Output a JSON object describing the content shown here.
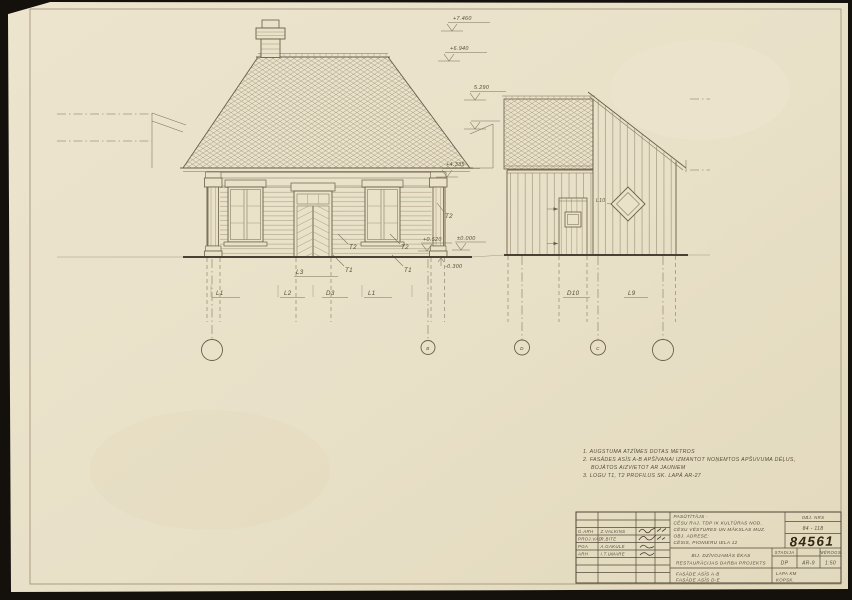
{
  "drawing": {
    "notes": {
      "line1": "1. AUGSTUMA ATZĪMES DOTAS METROS",
      "line2": "2. FASĀDES ASĪS A-B APŠĪVANAI IZMANTOT NOŅEMTOS APŠUVUMA DĒĻUS,",
      "line3": "BOJĀTOS AIZVIETOT AR JAUNIEM",
      "line4": "3. LOGU T1, T2 PROFILUS SK. LAPĀ AR-27"
    },
    "marks": {
      "top1": "+7.460",
      "top2": "+6.940",
      "roof_right": "5.290",
      "eaves": "+4.335",
      "plinth": "+0.520",
      "zero": "±0.000",
      "below": "-0.300"
    },
    "labels": {
      "t2_pilaster": "T2",
      "t2_left": "T2",
      "t2_right": "T2",
      "t1_left": "T1",
      "t1_right": "T1",
      "door_transom": "L3",
      "win1": "L1",
      "win2": "L2",
      "door": "D3",
      "win3": "L1",
      "diamond": "L10",
      "right_door": "D10",
      "right_win": "L9"
    },
    "axes": {
      "a2": "B",
      "a3": "D",
      "a4": "C"
    }
  },
  "title_block": {
    "sig_rows": [
      {
        "role": "G.ARH",
        "name": "Z.VALKINS"
      },
      {
        "role": "PROJ.VAD",
        "name": "R.BITE"
      },
      {
        "role": "PGA",
        "name": "A.GAKULE"
      },
      {
        "role": "ARH",
        "name": "I.T.UMARE"
      }
    ],
    "client": {
      "l1": "PASŪTĪTĀJS -",
      "l2": "CĒSU RAJ. TDP IK KULTŪRAS NOD.",
      "l3": "CĒSU VĒSTURES UN MĀKSLAS MUZ.",
      "l4": "OBJ. ADRESE:",
      "l5": "CĒSIS, PIONIERU IELA 12"
    },
    "obj_nr_label": "OBJ. NRS",
    "obj_nr": "84 - 118",
    "stamp": "84561",
    "project_l1": "BIJ. DZĪVOJAMĀS ĒKAS",
    "project_l2": "RESTAURĀCIJAS DARBA PROJEKTS",
    "stadija_label": "STADIJA",
    "stadija": "DP",
    "sheet": "AR-9",
    "merogs_label": "MĒROGS",
    "merogs": "1:50",
    "fasade_l1": "FASĀDE ASĪS A-B",
    "fasade_l2": "FASĀDE ASĪS D-E",
    "lapa": "LAPA KM",
    "kopsk": "KOPSK."
  }
}
